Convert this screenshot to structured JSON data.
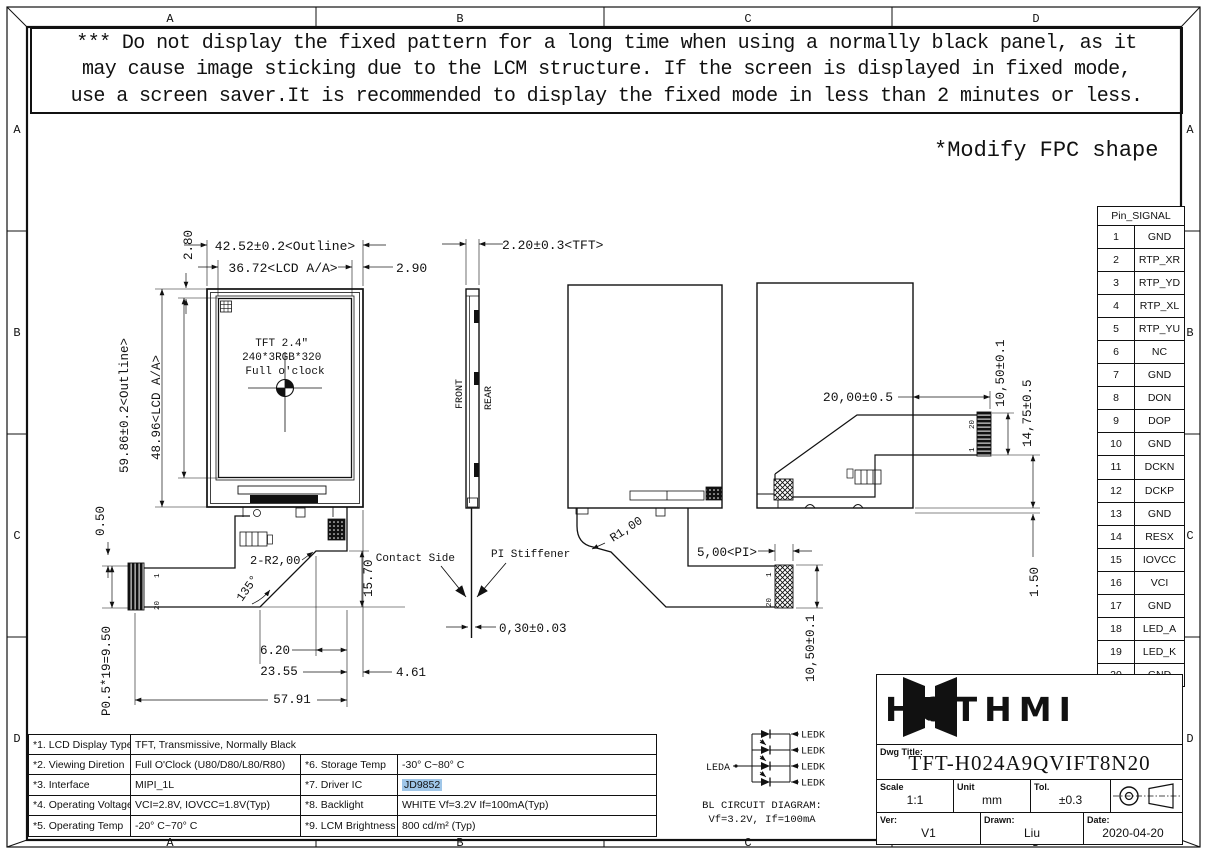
{
  "zones": {
    "cols": [
      "A",
      "B",
      "C",
      "D"
    ],
    "rows": [
      "A",
      "B",
      "C",
      "D"
    ]
  },
  "warning": {
    "line1": "*** Do not display the fixed pattern for a long time when using a normally black panel, as it",
    "line2": "may cause image sticking due to the LCM structure. If the screen is displayed in fixed mode,",
    "line3": "use a screen saver.It is recommended to display the fixed mode in less than 2 minutes or less."
  },
  "note": "*Modify FPC shape",
  "front_view": {
    "panel_line1": "TFT 2.4″",
    "panel_line2": "240*3RGB*320",
    "panel_line3": "Full o'clock",
    "dim_outline_w": "42.52±0.2<Outline>",
    "dim_aa_w": "36.72<LCD A/A>",
    "dim_right": "2.90",
    "dim_top": "2.80",
    "dim_outline_h": "59.86±0.2<Outline>",
    "dim_aa_h": "48.96<LCD A/A>",
    "dim_offset": "0.50",
    "dim_pitch": "P0.5*19=9.50",
    "dim_radius": "2-R2,00",
    "dim_angle": "135°",
    "dim_tail_h": "15.70",
    "dim_a": "6.20",
    "dim_b": "23.55",
    "dim_c": "4.61",
    "dim_total": "57.91",
    "pin_first": "1",
    "pin_last": "20"
  },
  "side_view": {
    "dim_tft": "2.20±0.3<TFT>",
    "front_label": "FRONT",
    "rear_label": "REAR",
    "contact_label": "Contact Side",
    "stiffener_label": "PI Stiffener",
    "dim_thickness": "0,30±0.03"
  },
  "rear_view": {
    "dim_radius": "R1,00",
    "dim_pi": "5,00<PI>",
    "dim_conn_w": "10,50±0.1",
    "pin_first": "1",
    "pin_last": "20"
  },
  "rear_view_folded": {
    "dim_fold": "20,00±0.5",
    "dim_conn": "10,50±0.1",
    "dim_offset": "14,75±0.5",
    "dim_bottom": "1.50",
    "pin_first": "1",
    "pin_last": "20"
  },
  "pin_table": {
    "header": "Pin_SIGNAL",
    "rows": [
      {
        "pin": "1",
        "signal": "GND"
      },
      {
        "pin": "2",
        "signal": "RTP_XR"
      },
      {
        "pin": "3",
        "signal": "RTP_YD"
      },
      {
        "pin": "4",
        "signal": "RTP_XL"
      },
      {
        "pin": "5",
        "signal": "RTP_YU"
      },
      {
        "pin": "6",
        "signal": "NC"
      },
      {
        "pin": "7",
        "signal": "GND"
      },
      {
        "pin": "8",
        "signal": "DON"
      },
      {
        "pin": "9",
        "signal": "DOP"
      },
      {
        "pin": "10",
        "signal": "GND"
      },
      {
        "pin": "11",
        "signal": "DCKN"
      },
      {
        "pin": "12",
        "signal": "DCKP"
      },
      {
        "pin": "13",
        "signal": "GND"
      },
      {
        "pin": "14",
        "signal": "RESX"
      },
      {
        "pin": "15",
        "signal": "IOVCC"
      },
      {
        "pin": "16",
        "signal": "VCI"
      },
      {
        "pin": "17",
        "signal": "GND"
      },
      {
        "pin": "18",
        "signal": "LED_A"
      },
      {
        "pin": "19",
        "signal": "LED_K"
      },
      {
        "pin": "20",
        "signal": "GND"
      }
    ]
  },
  "spec_table": {
    "r1_label": "*1. LCD Display Type",
    "r1_value": "TFT, Transmissive, Normally Black",
    "r2_label": "*2. Viewing Diretion",
    "r2_value": "Full O'Clock (U80/D80/L80/R80)",
    "r2_label2": "*6. Storage Temp",
    "r2_value2": "-30° C~80° C",
    "r3_label": "*3. Interface",
    "r3_value": "MIPI_1L",
    "r3_label2": "*7. Driver IC",
    "r3_value2": "JD9852",
    "r4_label": "*4. Operating Voltage",
    "r4_value": "VCI=2.8V, IOVCC=1.8V(Typ)",
    "r4_label2": "*8. Backlight",
    "r4_value2": "WHITE Vf=3.2V If=100mA(Typ)",
    "r5_label": "*5. Operating Temp",
    "r5_value": "-20° C~70° C",
    "r5_label2": "*9. LCM Brightness",
    "r5_value2": "800 cd/m² (Typ)",
    "highlight_color": "#9fc6e8"
  },
  "bl_circuit": {
    "anode": "LEDA",
    "cathode": "LEDK",
    "title": "BL CIRCUIT DIAGRAM:",
    "subtitle": "Vf=3.2V, If=100mA"
  },
  "title_block": {
    "logo": "HOTHMI",
    "dwg_title_label": "Dwg Title:",
    "dwg_title": "TFT-H024A9QVIFT8N20",
    "scale_label": "Scale",
    "scale": "1:1",
    "unit_label": "Unit",
    "unit": "mm",
    "tol_label": "Tol.",
    "tol": "±0.3",
    "ver_label": "Ver:",
    "ver": "V1",
    "drawn_label": "Drawn:",
    "drawn": "Liu",
    "date_label": "Date:",
    "date": "2020-04-20"
  }
}
